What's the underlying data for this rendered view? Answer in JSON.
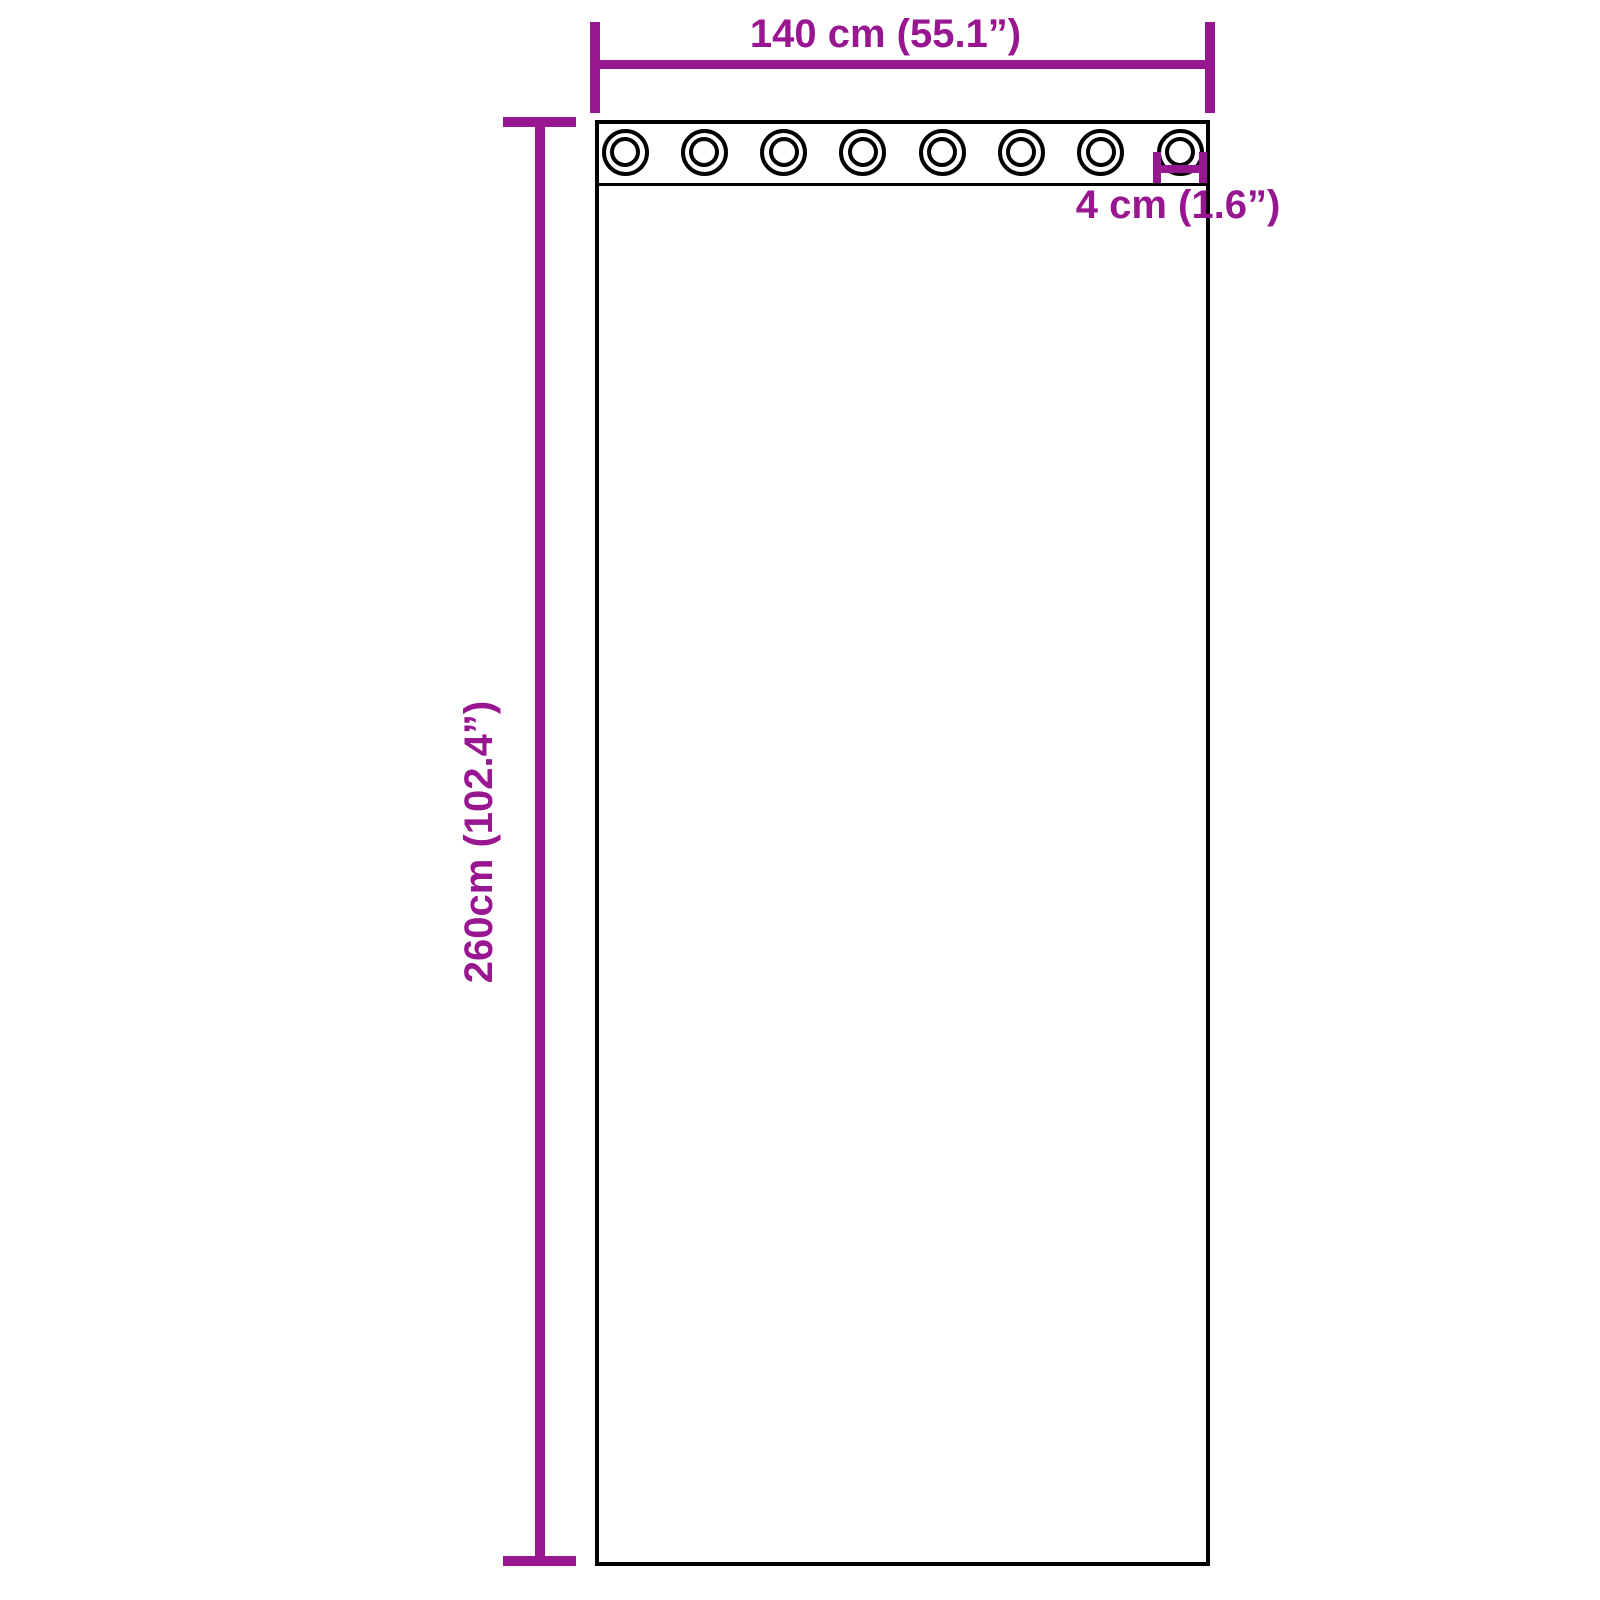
{
  "diagram": {
    "background_color": "#ffffff",
    "outline_color": "#000000",
    "dimension_color": "#981690",
    "width_label": "140 cm (55.1”)",
    "height_label": "260cm (102.4”)",
    "grommet_diameter_label": "4 cm (1.6”)",
    "grommets": {
      "count": 8
    }
  }
}
